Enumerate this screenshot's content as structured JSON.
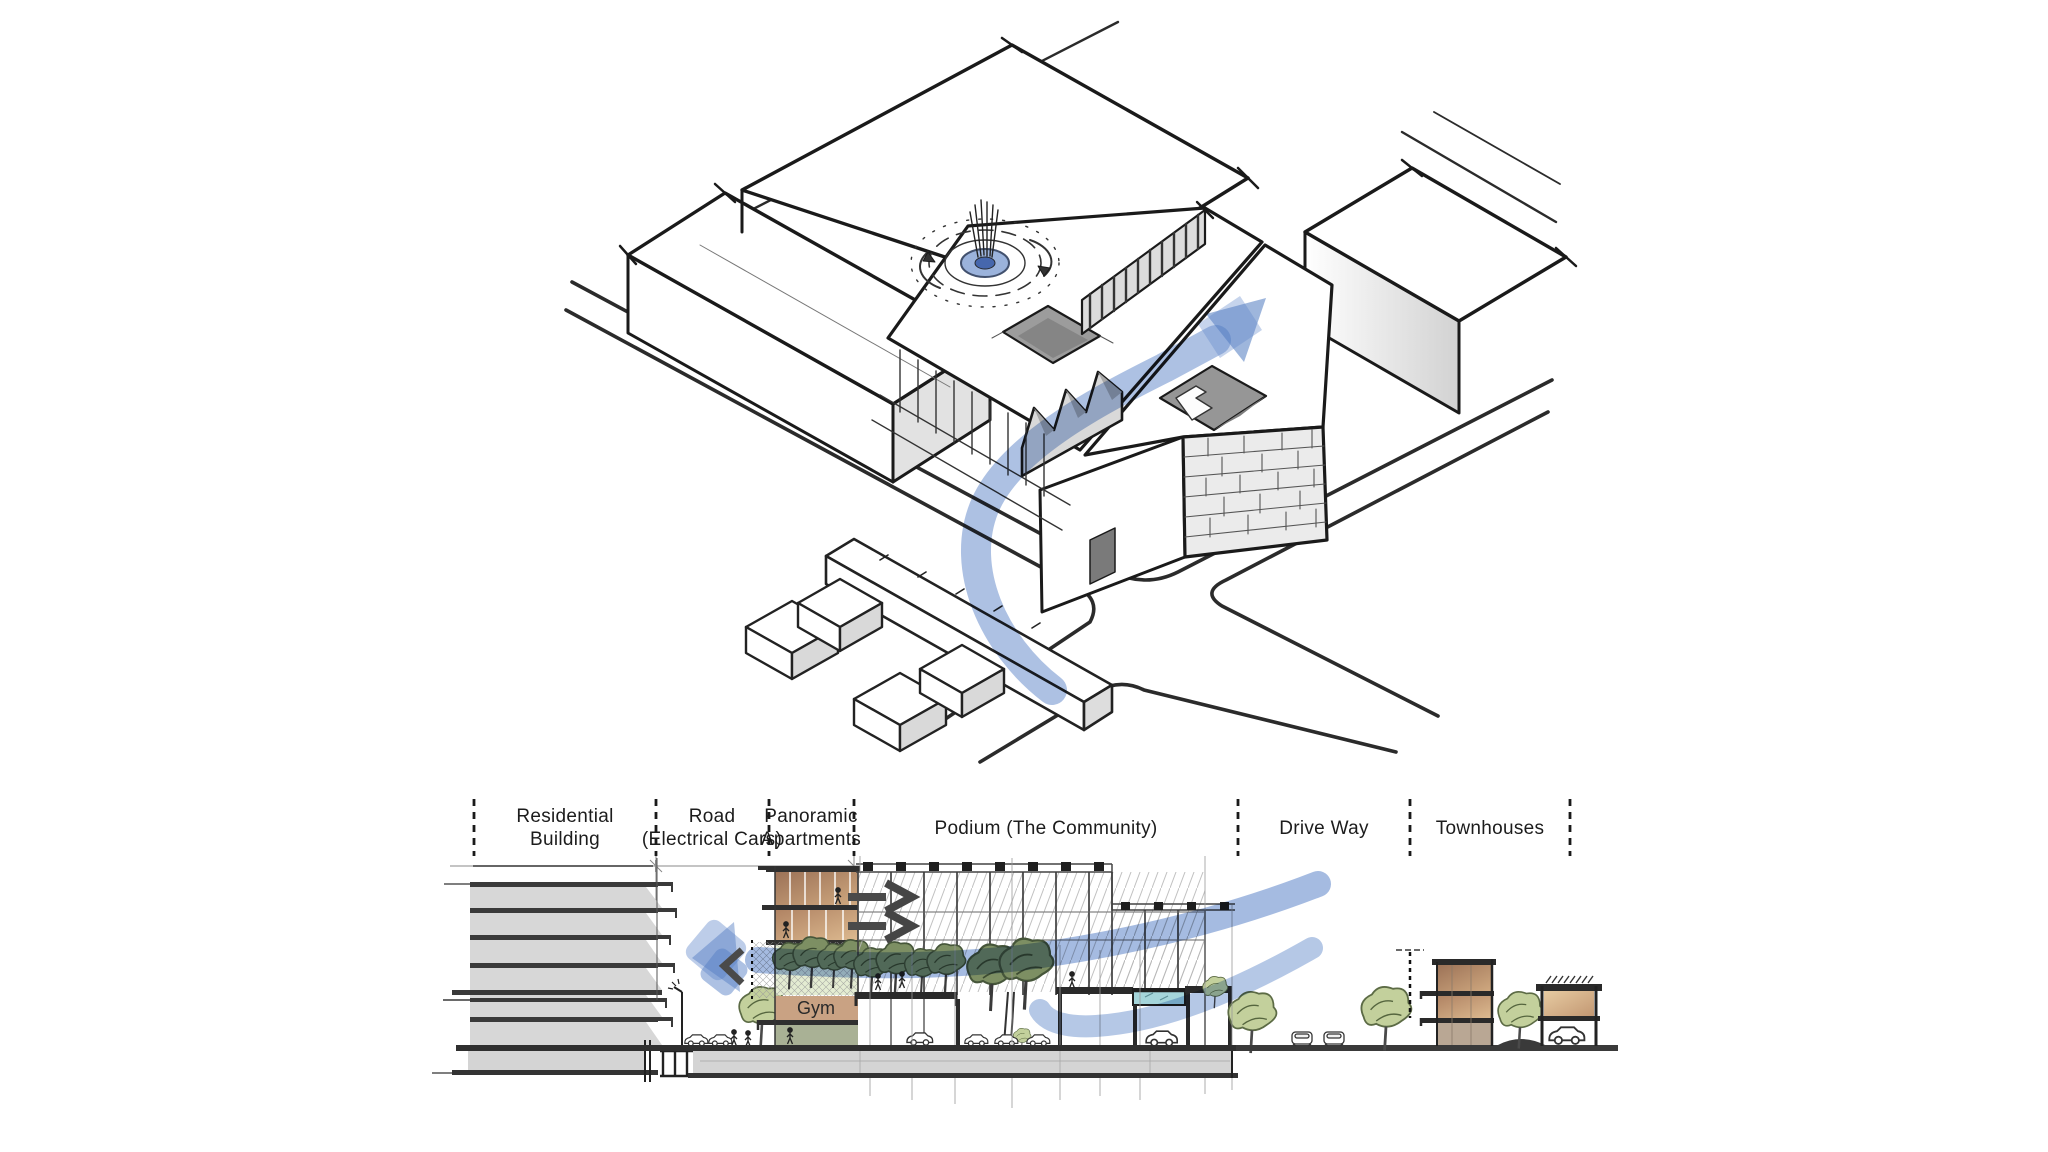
{
  "colors": {
    "flow_blue": "#5b84c8",
    "flow_blue_dark": "#4f7ac0",
    "sketch_ink": "#1f1f1f",
    "face_gray": "#dcdcdc",
    "brown_floor": "#a87c5e",
    "tan_light": "#cfa87f",
    "gym_tan": "#c9a283",
    "lower_band_green": "#a9b195",
    "tree_olive": "#7d8f63",
    "tree_light_green": "#c3d09c",
    "pool_blue": "#a5d5da"
  },
  "section": {
    "labels": [
      {
        "line1": "Residential",
        "line2": "Building"
      },
      {
        "line1": "Road",
        "line2": "(Electrical Cars)"
      },
      {
        "line1": "Panoramic",
        "line2": "Apartments"
      },
      {
        "line1": "Podium (The Community)",
        "line2": ""
      },
      {
        "line1": "Drive Way",
        "line2": ""
      },
      {
        "line1": "Townhouses",
        "line2": ""
      }
    ],
    "gym_label": "Gym"
  }
}
